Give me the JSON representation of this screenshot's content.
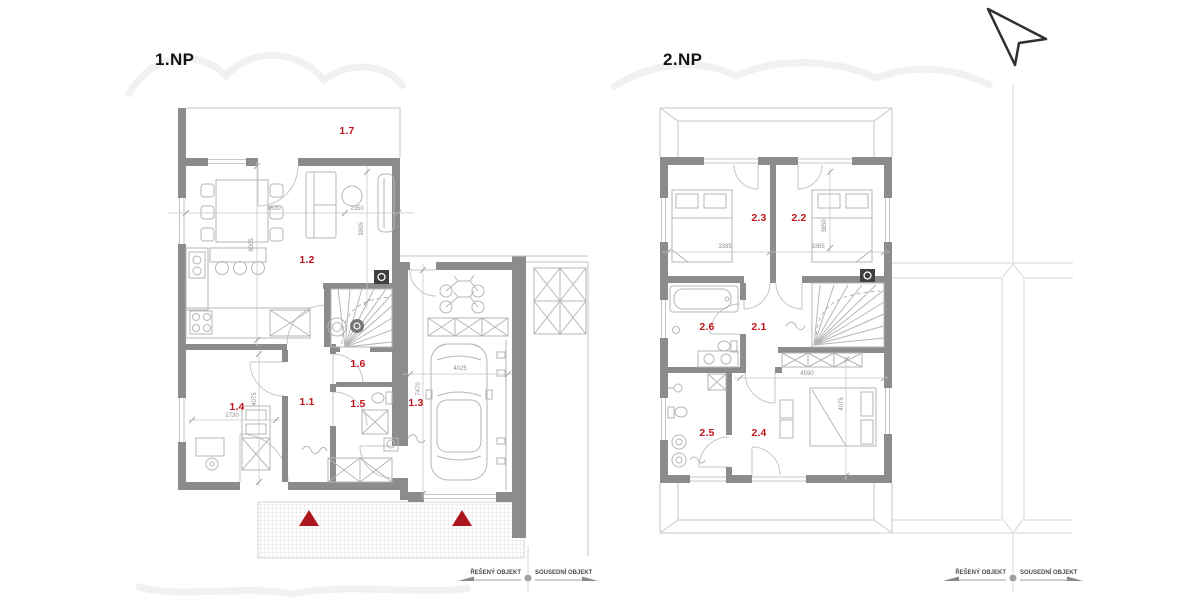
{
  "titles": {
    "floor1": "1.NP",
    "floor2": "2.NP"
  },
  "floor1": {
    "rooms": {
      "r11": "1.1",
      "r12": "1.2",
      "r13": "1.3",
      "r14": "1.4",
      "r15": "1.5",
      "r16": "1.6",
      "r17": "1.7"
    },
    "dims": {
      "d4530": "4530",
      "d2350": "2350",
      "d3905": "3905",
      "d6005": "6005",
      "d2730": "2730",
      "d4075": "4075",
      "d4025": "4025",
      "d7470": "7470"
    }
  },
  "floor2": {
    "rooms": {
      "r21": "2.1",
      "r22": "2.2",
      "r23": "2.3",
      "r24": "2.4",
      "r25": "2.5",
      "r26": "2.6"
    },
    "dims": {
      "d3385a": "3385",
      "d3385b": "3385",
      "d3850": "3850",
      "d4590": "4590",
      "d4075": "4075"
    }
  },
  "legend": {
    "solved": "ŘEŠENÝ OBJEKT",
    "neighbor": "SOUSEDNÍ OBJEKT"
  },
  "colors": {
    "wall": "#8c8c8c",
    "thin_line": "#c6c6c6",
    "furniture_line": "#b6b6b6",
    "room_label": "#c1161d",
    "entrance_marker": "#ae161e",
    "paving": "#e3dad8",
    "chimney": "#3f3f3f"
  }
}
